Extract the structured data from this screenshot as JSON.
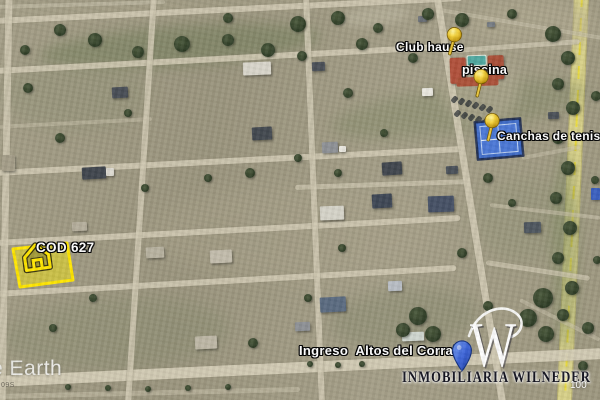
{
  "watermarks": {
    "earth_logo": "e Earth",
    "corner_code": "09S",
    "scale_label": "100"
  },
  "branding": {
    "logo_letter": "W",
    "agency_name": "INMOBILIARIA WILNEDER"
  },
  "placemarks": {
    "club_house": {
      "label": "Club hause",
      "pin": "yellow-pushpin"
    },
    "pool": {
      "label": "piscina",
      "pin": "yellow-pushpin"
    },
    "tennis_courts": {
      "label": "Canchas de tenis",
      "pin": "yellow-pushpin"
    },
    "entrance": {
      "label": "Ingreso  Altos del Corral",
      "pin": "blue-pin"
    },
    "featured_lot": {
      "label": "COD 627",
      "highlight": "yellow-polygon",
      "icon": "house-icon"
    }
  },
  "colors": {
    "terrain": "#9e9881",
    "road": "#cfc8b1",
    "highway": "#d7d088",
    "highway_dash": "#e8d93a",
    "tennis_court": "#3f6cc8",
    "clubhouse_roof": "#b0503a",
    "pool_water": "#4fa8a0",
    "lot_highlight": "#ffe600",
    "pin_yellow": "#f5d33c",
    "pin_blue": "#3c64d8",
    "label_text": "#ffffff",
    "agency_text": "#12121e"
  },
  "map_features": {
    "roads": [
      [
        -5,
        7,
        165,
        2,
        4,
        "#c8c2ac",
        0.55
      ],
      [
        -5,
        21,
        462,
        -2,
        6,
        "#cfc8b1",
        0.9
      ],
      [
        440,
        10,
        602,
        38,
        4,
        "#c6bfa8",
        0.6
      ],
      [
        -5,
        71,
        458,
        46,
        6,
        "#cfc8b1",
        0.9
      ],
      [
        456,
        50,
        580,
        41,
        5,
        "#cbc4ad",
        0.8
      ],
      [
        -5,
        127,
        152,
        119,
        4,
        "#c6bfa8",
        0.5
      ],
      [
        -5,
        173,
        462,
        149,
        6,
        "#cfc8b1",
        0.9
      ],
      [
        522,
        158,
        580,
        147,
        4,
        "#c6bfa8",
        0.5
      ],
      [
        295,
        187,
        470,
        181,
        5,
        "#cbc4ad",
        0.75
      ],
      [
        -5,
        243,
        460,
        218,
        6,
        "#cfc8b1",
        0.9
      ],
      [
        490,
        205,
        600,
        218,
        4,
        "#c6bfa8",
        0.6
      ],
      [
        -5,
        294,
        456,
        268,
        6,
        "#cfc8b1",
        0.9
      ],
      [
        486,
        262,
        590,
        278,
        5,
        "#cbc4ad",
        0.75
      ],
      [
        520,
        300,
        600,
        340,
        4,
        "#c6bfa8",
        0.5
      ],
      [
        -5,
        381,
        604,
        353,
        11,
        "#d3ccb5",
        0.95
      ],
      [
        -5,
        396,
        300,
        389,
        5,
        "#c9c2ab",
        0.5
      ],
      [
        9,
        -5,
        2,
        405,
        7,
        "#cfc8b1",
        0.85
      ],
      [
        154,
        -5,
        128,
        405,
        6,
        "#cfc8b1",
        0.85
      ],
      [
        306,
        -5,
        322,
        405,
        6,
        "#cfc8b1",
        0.85
      ],
      [
        437,
        -5,
        503,
        405,
        7,
        "#d0c9b2",
        0.9
      ]
    ],
    "patches": [
      [
        40,
        26,
        280,
        40,
        -4,
        "#6e7a55",
        0.5,
        6
      ],
      [
        330,
        85,
        260,
        48,
        -8,
        "#7d8562",
        0.42,
        7
      ],
      [
        0,
        58,
        150,
        72,
        0,
        "#8a8d70",
        0.32,
        8
      ],
      [
        330,
        288,
        150,
        62,
        -5,
        "#7e8266",
        0.38,
        8
      ],
      [
        0,
        298,
        230,
        72,
        -3,
        "#85896c",
        0.38,
        8
      ],
      [
        476,
        178,
        100,
        84,
        0,
        "#8b8f70",
        0.3,
        8
      ],
      [
        552,
        150,
        26,
        200,
        0,
        "#7e8a5e",
        0.45,
        6
      ],
      [
        470,
        0,
        130,
        48,
        0,
        "#b2ab91",
        0.5,
        8
      ],
      [
        150,
        185,
        290,
        95,
        0,
        "#a8a189",
        0.45,
        10
      ],
      [
        440,
        52,
        80,
        72,
        0,
        "#b3ac94",
        0.55,
        6
      ],
      [
        340,
        6,
        70,
        20,
        -6,
        "#c6c1ab",
        0.4,
        4
      ],
      [
        0,
        0,
        340,
        16,
        -2,
        "#a9a38a",
        0.5,
        5
      ]
    ],
    "trees": [
      [
        95,
        40,
        7
      ],
      [
        138,
        52,
        6
      ],
      [
        182,
        44,
        8
      ],
      [
        228,
        40,
        6
      ],
      [
        268,
        50,
        7
      ],
      [
        298,
        24,
        8
      ],
      [
        338,
        18,
        7
      ],
      [
        362,
        44,
        6
      ],
      [
        302,
        56,
        5
      ],
      [
        428,
        14,
        6
      ],
      [
        462,
        20,
        7
      ],
      [
        512,
        14,
        5
      ],
      [
        553,
        34,
        8
      ],
      [
        568,
        58,
        7
      ],
      [
        558,
        84,
        6
      ],
      [
        573,
        108,
        7
      ],
      [
        558,
        138,
        6
      ],
      [
        568,
        168,
        7
      ],
      [
        556,
        198,
        6
      ],
      [
        570,
        228,
        7
      ],
      [
        558,
        258,
        6
      ],
      [
        572,
        288,
        7
      ],
      [
        543,
        298,
        10
      ],
      [
        528,
        318,
        9
      ],
      [
        546,
        334,
        8
      ],
      [
        418,
        316,
        9
      ],
      [
        433,
        334,
        8
      ],
      [
        403,
        330,
        7
      ],
      [
        60,
        30,
        6
      ],
      [
        25,
        50,
        5
      ],
      [
        228,
        18,
        5
      ],
      [
        378,
        28,
        5
      ],
      [
        413,
        58,
        5
      ],
      [
        348,
        93,
        5
      ],
      [
        384,
        133,
        4
      ],
      [
        250,
        173,
        5
      ],
      [
        208,
        178,
        4
      ],
      [
        145,
        188,
        4
      ],
      [
        60,
        138,
        5
      ],
      [
        128,
        113,
        4
      ],
      [
        28,
        88,
        5
      ],
      [
        298,
        158,
        4
      ],
      [
        338,
        173,
        4
      ],
      [
        488,
        178,
        5
      ],
      [
        512,
        203,
        4
      ],
      [
        462,
        253,
        5
      ],
      [
        93,
        298,
        4
      ],
      [
        53,
        328,
        4
      ],
      [
        253,
        343,
        5
      ],
      [
        308,
        298,
        4
      ],
      [
        588,
        328,
        6
      ],
      [
        583,
        366,
        5
      ],
      [
        596,
        96,
        5
      ],
      [
        595,
        180,
        4
      ],
      [
        597,
        260,
        4
      ],
      [
        342,
        248,
        4
      ],
      [
        488,
        306,
        5
      ],
      [
        563,
        315,
        6
      ],
      [
        68,
        387,
        3
      ],
      [
        108,
        388,
        3
      ],
      [
        148,
        389,
        3
      ],
      [
        188,
        388,
        3
      ],
      [
        228,
        387,
        3
      ],
      [
        310,
        364,
        3
      ],
      [
        338,
        365,
        3
      ],
      [
        362,
        364,
        3
      ]
    ],
    "houses": [
      [
        112,
        87,
        16,
        11,
        -3,
        "#474d55"
      ],
      [
        82,
        167,
        24,
        12,
        -3,
        "#3f454d"
      ],
      [
        106,
        168,
        8,
        8,
        0,
        "#dcd9d0"
      ],
      [
        243,
        62,
        28,
        13,
        -2,
        "#d8d5ca"
      ],
      [
        252,
        127,
        20,
        13,
        -3,
        "#42484f"
      ],
      [
        312,
        62,
        13,
        9,
        -2,
        "#4a5057"
      ],
      [
        322,
        142,
        16,
        11,
        -3,
        "#8d9095"
      ],
      [
        339,
        146,
        7,
        6,
        0,
        "#e9e7df"
      ],
      [
        422,
        88,
        11,
        8,
        -2,
        "#e9e7df"
      ],
      [
        382,
        162,
        20,
        13,
        -4,
        "#3f454d"
      ],
      [
        446,
        166,
        12,
        8,
        -3,
        "#495058"
      ],
      [
        320,
        206,
        24,
        14,
        -2,
        "#d5d3c8"
      ],
      [
        372,
        194,
        20,
        14,
        -3,
        "#3d4654"
      ],
      [
        428,
        196,
        26,
        16,
        -2,
        "#455064"
      ],
      [
        524,
        222,
        17,
        11,
        -2,
        "#4e565e"
      ],
      [
        320,
        297,
        26,
        15,
        -3,
        "#5a6a80"
      ],
      [
        388,
        281,
        14,
        10,
        -2,
        "#b8bdc4"
      ],
      [
        295,
        322,
        15,
        9,
        -2,
        "#8d9095"
      ],
      [
        146,
        247,
        18,
        11,
        -3,
        "#b8b2a0"
      ],
      [
        210,
        250,
        22,
        13,
        -3,
        "#c2bcab"
      ],
      [
        72,
        222,
        15,
        9,
        -2,
        "#b5ae9c"
      ],
      [
        195,
        336,
        22,
        13,
        -3,
        "#bdb7a5"
      ],
      [
        548,
        112,
        11,
        7,
        -2,
        "#4a5057"
      ],
      [
        418,
        16,
        9,
        6,
        -2,
        "#6b7077"
      ],
      [
        487,
        22,
        8,
        5,
        -2,
        "#777d84"
      ],
      [
        402,
        332,
        22,
        9,
        -2,
        "#cfd6cf"
      ],
      [
        2,
        155,
        13,
        16,
        0,
        "#a49d88"
      ],
      [
        591,
        188,
        9,
        12,
        0,
        "#3a5fc0"
      ]
    ],
    "parking_dots": [
      [
        452,
        96
      ],
      [
        459,
        98
      ],
      [
        466,
        100
      ],
      [
        473,
        102
      ],
      [
        480,
        104
      ],
      [
        487,
        106
      ],
      [
        455,
        110
      ],
      [
        462,
        112
      ],
      [
        469,
        114
      ],
      [
        476,
        116
      ],
      [
        483,
        118
      ],
      [
        490,
        118
      ]
    ]
  }
}
